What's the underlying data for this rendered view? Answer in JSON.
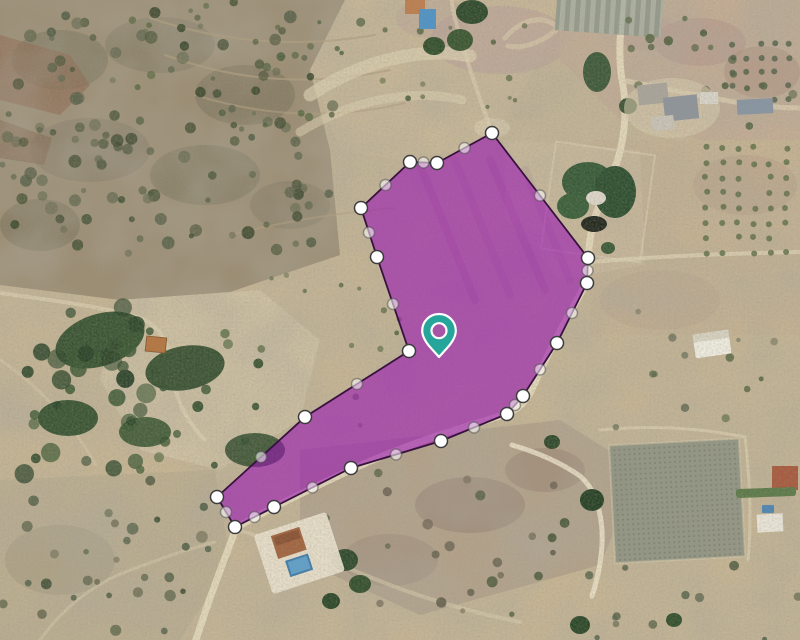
{
  "window": {
    "width": 800,
    "height": 640
  },
  "map": {
    "type": "satellite-aerial",
    "base_terrain_color": "#c7b695",
    "road_color": "#e6dabc",
    "vegetation_color": "#3d5434",
    "scrub_color": "#97886f"
  },
  "parcel": {
    "fill_color": "#9913b5",
    "fill_opacity": 0.58,
    "stroke_color": "#38123f",
    "stroke_width": 1.8,
    "vertices": [
      [
        492,
        133
      ],
      [
        437,
        163
      ],
      [
        410,
        162
      ],
      [
        361,
        208
      ],
      [
        377,
        257
      ],
      [
        409,
        351
      ],
      [
        305,
        417
      ],
      [
        217,
        497
      ],
      [
        235,
        527
      ],
      [
        274,
        507
      ],
      [
        351,
        468
      ],
      [
        441,
        441
      ],
      [
        507,
        414
      ],
      [
        523,
        396
      ],
      [
        557,
        343
      ],
      [
        587,
        283
      ],
      [
        588,
        258
      ]
    ],
    "vertex_marker": {
      "shape": "circle",
      "radius": 6.5,
      "fill": "#ffffff",
      "stroke": "#3c3c3c",
      "stroke_width": 1.5
    },
    "midpoint_marker": {
      "shape": "circle",
      "radius": 5.5,
      "fill": "#ffffff",
      "fill_opacity": 0.55,
      "stroke": "#4a4a4a",
      "stroke_opacity": 0.5,
      "stroke_width": 1.5
    }
  },
  "location_pin": {
    "tip_x": 439,
    "tip_y": 357,
    "color": "#26a69a",
    "outline_color": "#ffffff"
  }
}
